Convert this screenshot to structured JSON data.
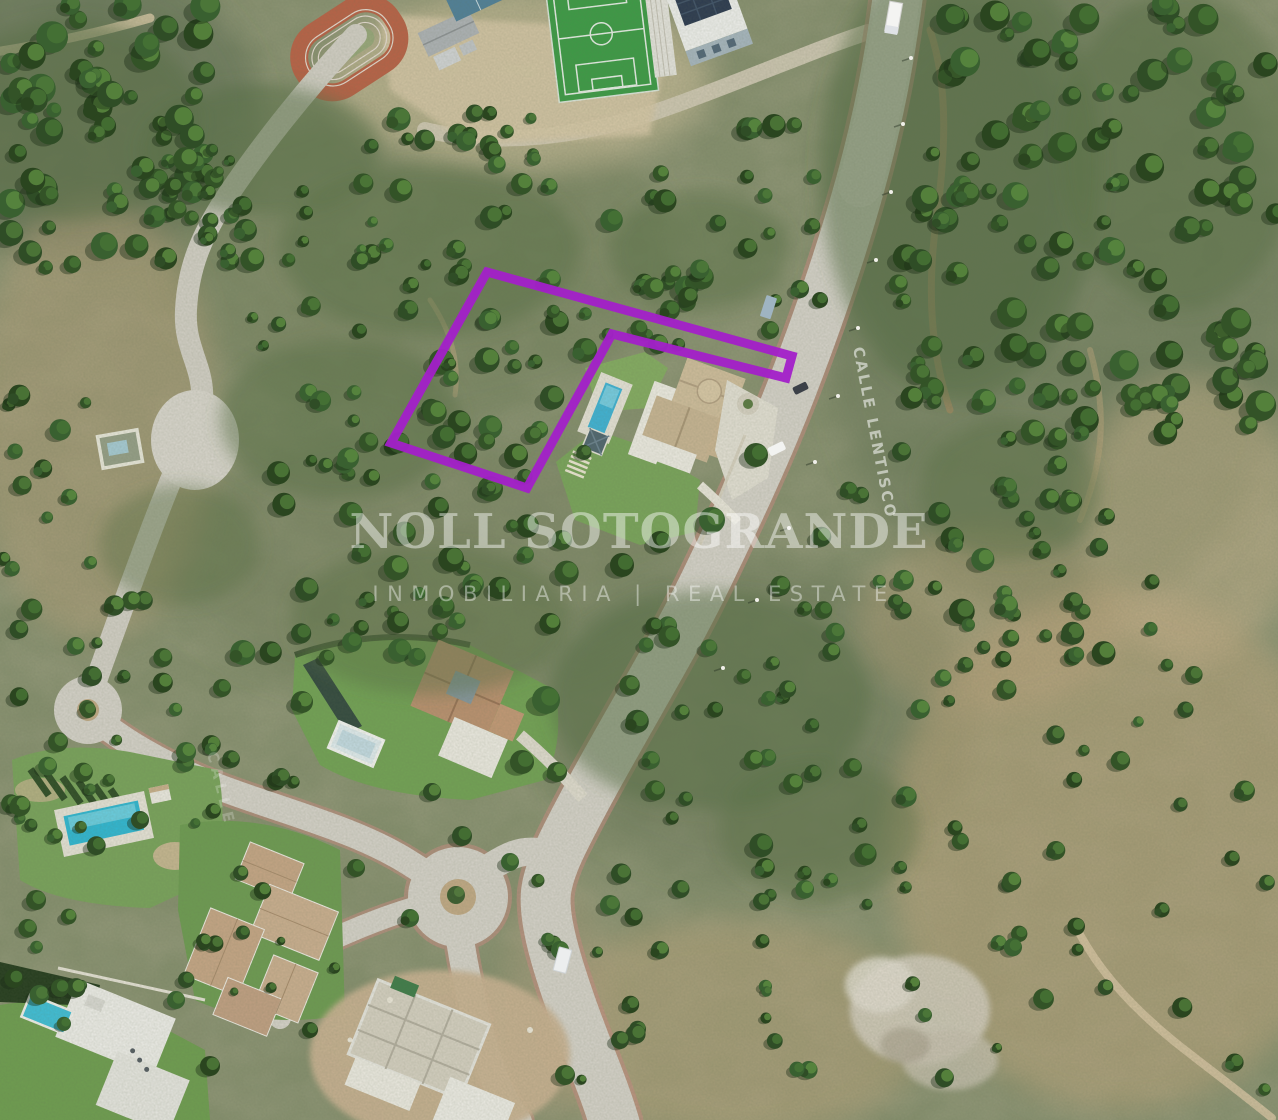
{
  "map": {
    "watermark": {
      "title": "NOLL SOTOGRANDE",
      "subtitle": "INMOBILIARIA | REAL ESTATE"
    },
    "road_labels": [
      {
        "text": "CALLE LENTISCO"
      },
      {
        "text": "CALLE"
      }
    ],
    "plot_outline": {
      "color": "#A320C9",
      "stroke_width": 9,
      "points": "487,272 792,356 786,378 612,334 527,488 391,443"
    },
    "palette": {
      "plot_accent": "#A320C9",
      "pool_water": "#3FB4D8",
      "soccer_turf": "#3C9C46",
      "running_track": "#BB6247",
      "road_surface": "#D8D4CC",
      "road_edge_pink": "#C98E84"
    }
  }
}
